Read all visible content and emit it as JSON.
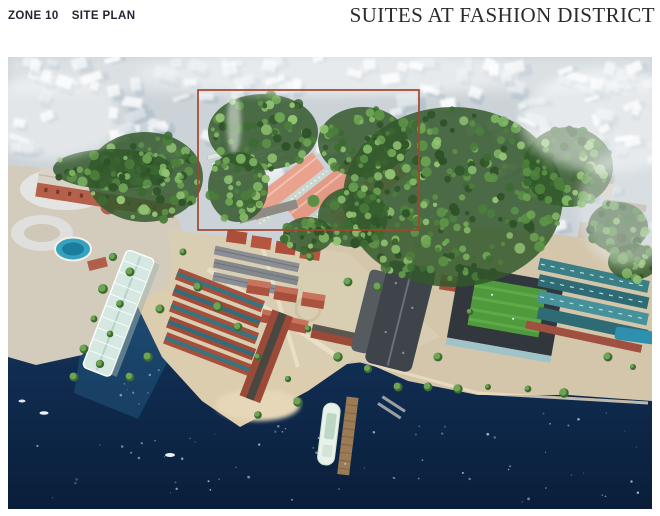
{
  "header": {
    "zone_label": "ZONE 10",
    "plan_label": "SITE PLAN",
    "title": "SUITES AT FASHION DISTRICT"
  },
  "image": {
    "alt": "Aerial rendering of the Fashion District waterfront: forested hill, heritage warehouses, suites buildings outlined in red, piers and dark blue harbour water",
    "highlight": {
      "label": "Suites at Fashion District site",
      "x": 190,
      "y": 33,
      "width": 221,
      "height": 140
    }
  },
  "colors": {
    "highlight": "#a3452c",
    "water_deep": "#0a1e3a",
    "water_light": "#1b3f66",
    "haze": "#ccd3d8",
    "foliage": "#4c7f3b",
    "sand": "#d9c9a8",
    "brick": "#a84e3c",
    "salmon_roof": "#e8a28e",
    "teal_roof": "#3b7f86",
    "header_text": "#1f2430",
    "title_text": "#2b2b2b"
  }
}
